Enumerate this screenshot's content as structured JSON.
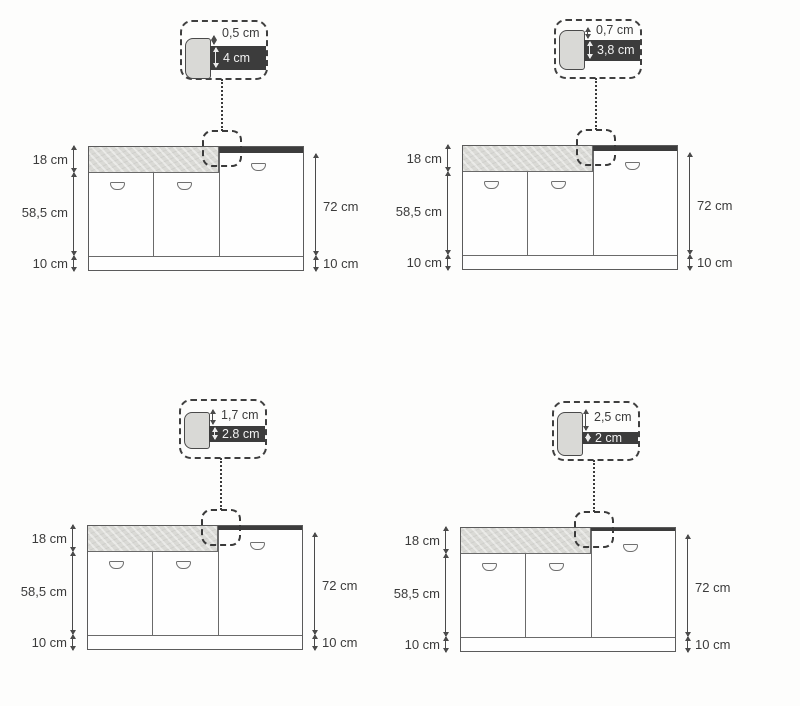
{
  "description": "Four kitchen base-cabinet elevation diagrams comparing worktop thickness and front reveal gap",
  "colors": {
    "worktop_dark": "#3c3c3c",
    "drawer_band_gray": "#dadad6",
    "line": "#5b5b5b",
    "background": "#fdfdfc"
  },
  "panels": [
    {
      "position": "top-left",
      "callout": {
        "reveal_gap": "0,5 cm",
        "worktop_thickness": "4 cm"
      },
      "dimensions": {
        "drawer_height": "18 cm",
        "door_height": "58,5 cm",
        "plinth_left": "10 cm",
        "right_door_height": "72 cm",
        "plinth_right": "10 cm"
      }
    },
    {
      "position": "top-right",
      "callout": {
        "reveal_gap": "0,7 cm",
        "worktop_thickness": "3,8 cm"
      },
      "dimensions": {
        "drawer_height": "18 cm",
        "door_height": "58,5 cm",
        "plinth_left": "10 cm",
        "right_door_height": "72 cm",
        "plinth_right": "10 cm"
      }
    },
    {
      "position": "bottom-left",
      "callout": {
        "reveal_gap": "1,7 cm",
        "worktop_thickness": "2.8 cm"
      },
      "dimensions": {
        "drawer_height": "18 cm",
        "door_height": "58,5 cm",
        "plinth_left": "10 cm",
        "right_door_height": "72 cm",
        "plinth_right": "10 cm"
      }
    },
    {
      "position": "bottom-right",
      "callout": {
        "reveal_gap": "2,5 cm",
        "worktop_thickness": "2 cm"
      },
      "dimensions": {
        "drawer_height": "18 cm",
        "door_height": "58,5 cm",
        "plinth_left": "10 cm",
        "right_door_height": "72 cm",
        "plinth_right": "10 cm"
      }
    }
  ]
}
